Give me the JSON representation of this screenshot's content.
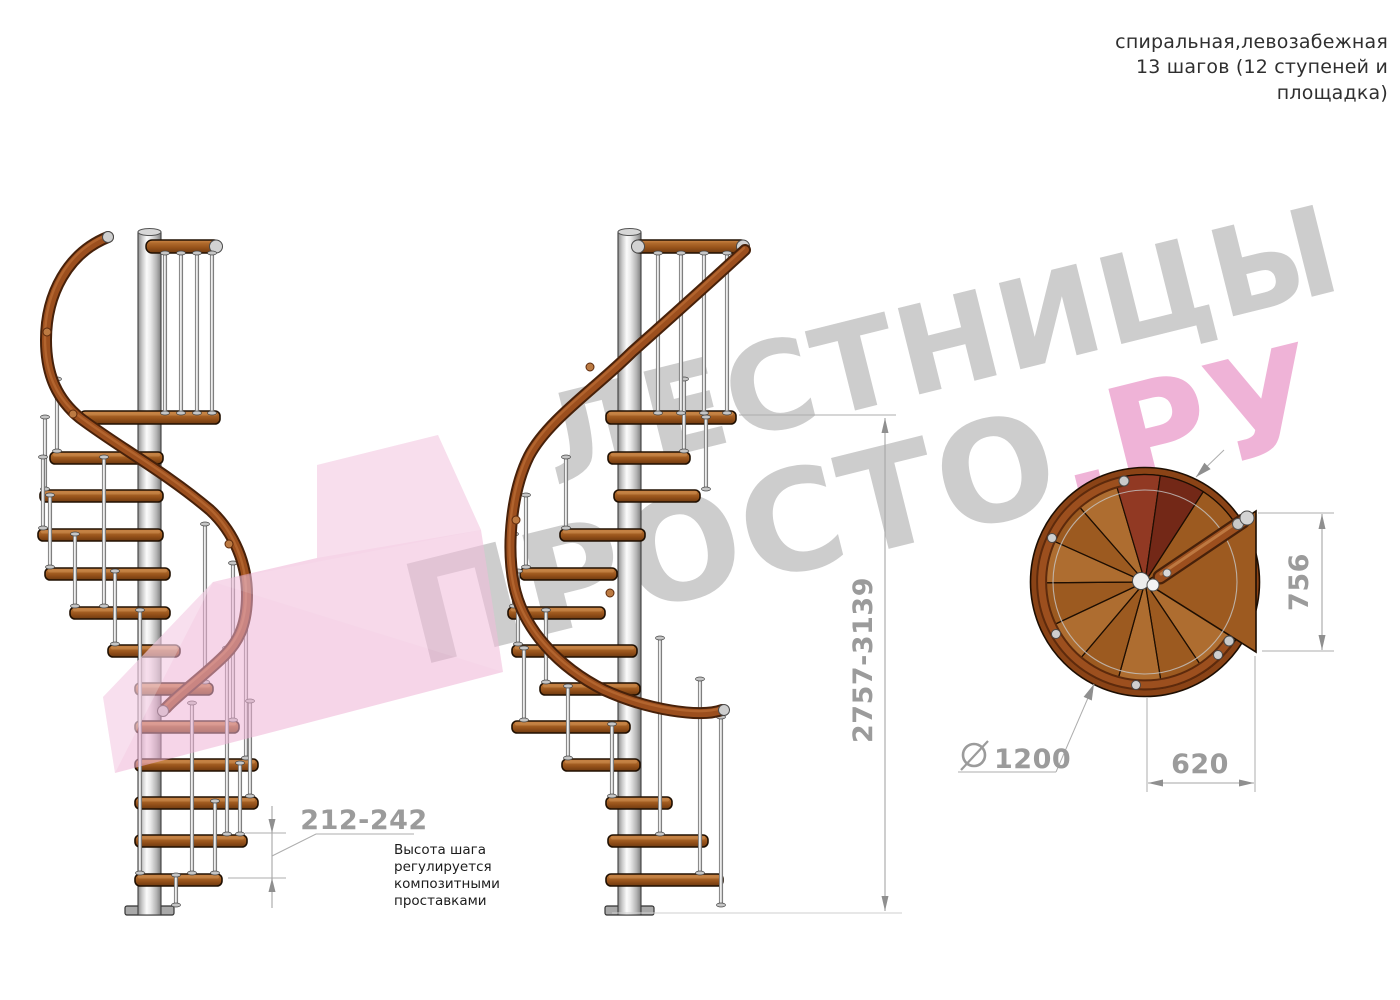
{
  "header": {
    "lines": [
      "спиральная,левозабежная",
      "13 шагов (12 ступеней и",
      "площадка)"
    ]
  },
  "watermark": {
    "line1": "ЛЕСТНИЦЫ",
    "line2_gray": "ПРОСТО",
    "line2_pink": ".РУ",
    "gray_color": "#cdcdcd",
    "pink_color": "#efb3d7",
    "logo_pink": "#eeb3d6"
  },
  "dimensions": {
    "step_height": "212-242",
    "total_height": "2757-3139",
    "plan_depth": "756",
    "plan_width": "620",
    "diameter": "1200"
  },
  "note": {
    "text": "Высота шага\nрегулируется\nкомпозитными\nпроставками"
  },
  "colors": {
    "wood": "#a86324",
    "handrail": "#9c4f1e",
    "metal": "#d9d9d9",
    "dimension_gray": "#9b9b9b",
    "entry_step_maroon": "#7c2b1b"
  }
}
